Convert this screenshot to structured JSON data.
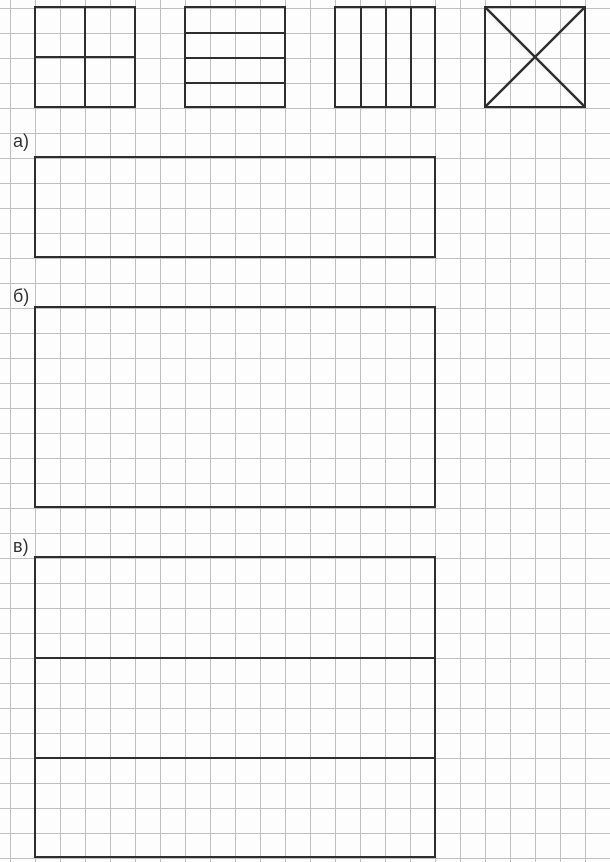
{
  "page": {
    "kind": "math-worksheet-on-grid-paper"
  },
  "colors": {
    "background": "#fdfdfd",
    "grid_line": "#bfbfbf",
    "figure_line": "#2e2e2e",
    "label_text": "#333333"
  },
  "grid": {
    "cell_size_px": 25,
    "offset_x_px": 10,
    "offset_y_px": 8
  },
  "examples": [
    {
      "name": "square-divided-into-4-equal-squares"
    },
    {
      "name": "square-divided-into-4-horizontal-strips"
    },
    {
      "name": "square-divided-into-4-vertical-strips"
    },
    {
      "name": "square-divided-by-two-diagonals"
    }
  ],
  "tasks": [
    {
      "label": "а)",
      "figure": "empty-rectangle-16x4-cells"
    },
    {
      "label": "б)",
      "figure": "empty-rectangle-16x8-cells"
    },
    {
      "label": "в)",
      "figure": "rectangle-16x12-cells-split-into-3-horizontal-strips"
    }
  ]
}
